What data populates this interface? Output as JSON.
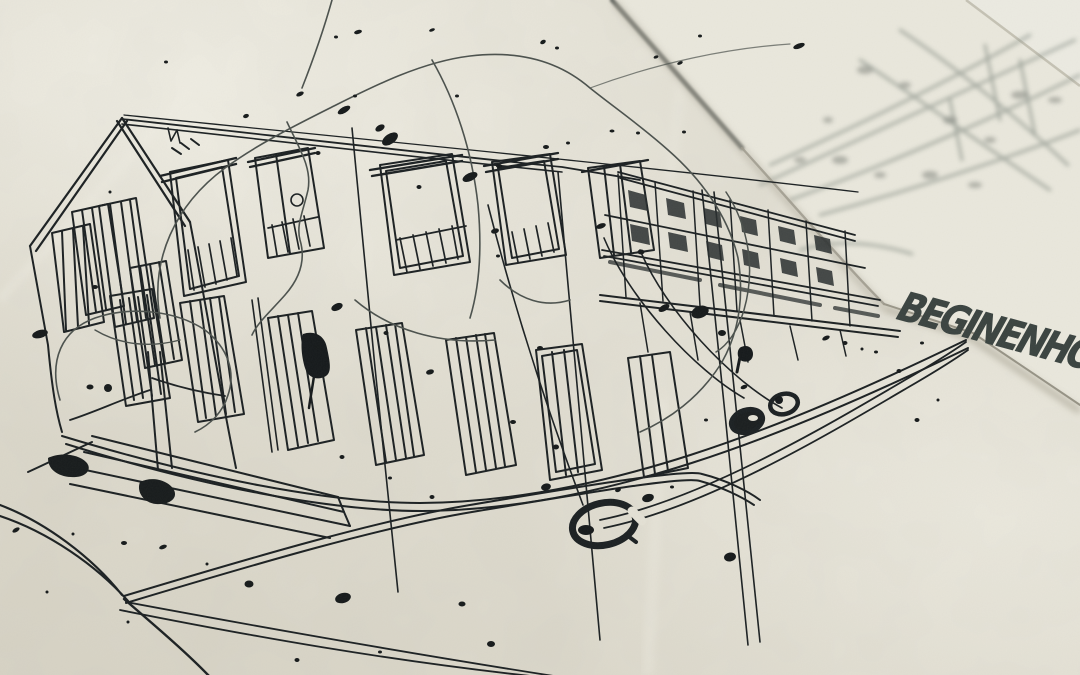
{
  "scene": {
    "type": "photograph",
    "subject": "hand-drawn architectural ink sketch on paper",
    "description": "Close-up photo of a freehand pen sketch: street facade of a residential building with tall shuttered windows, a gabled roof at left, trees, hanging street lamps and ink splatters. A second, out-of-focus sketch sheet overlaps the top-right corner and carries a handwritten project label."
  },
  "annotation": {
    "text": "BEGINENHOF"
  },
  "palette": {
    "paper": "#e6e3d8",
    "paper_light": "#efede2",
    "paper_shadow": "#c9c4b4",
    "ink": "#181d1e",
    "ink_light": "#4a504c",
    "blurred_sketch": "#8f968e"
  }
}
